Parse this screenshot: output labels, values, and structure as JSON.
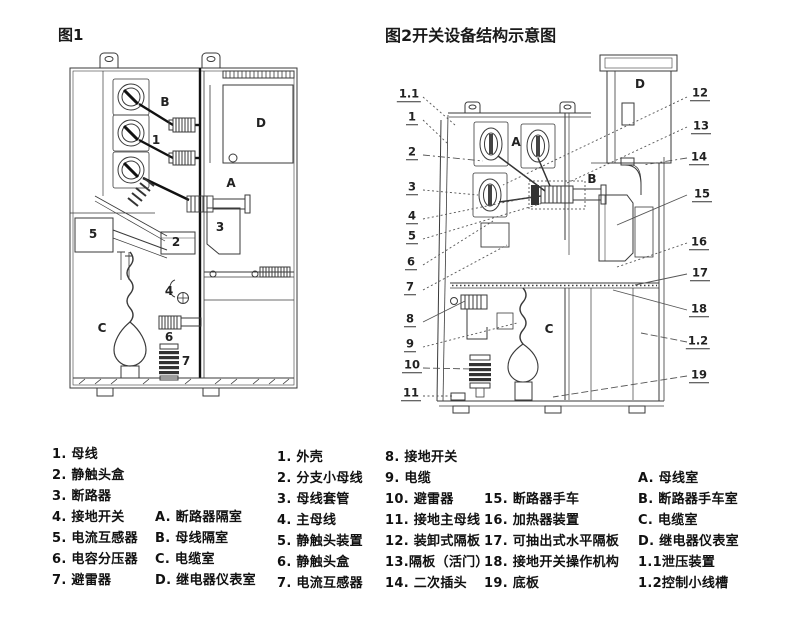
{
  "titles": {
    "fig1": "图1",
    "fig2": "图2开关设备结构示意图"
  },
  "colors": {
    "line": "#3a3a3a",
    "heavy_line": "#111111",
    "text": "#1a1a1a"
  },
  "fig1": {
    "labels": [
      "B",
      "1",
      "D",
      "A",
      "3",
      "2",
      "5",
      "4",
      "C",
      "6",
      "7"
    ]
  },
  "fig2": {
    "inner_labels": [
      "A",
      "B",
      "C",
      "D"
    ],
    "callouts_left": [
      "1.1",
      "1",
      "2",
      "3",
      "4",
      "5",
      "6",
      "7",
      "8",
      "9",
      "10",
      "11"
    ],
    "callouts_right": [
      "12",
      "13",
      "14",
      "15",
      "16",
      "17",
      "18",
      "1.2",
      "19"
    ]
  },
  "legend": {
    "col1": [
      "1. 母线",
      "2. 静触头盒",
      "3. 断路器",
      "4. 接地开关",
      "5. 电流互感器",
      "6. 电容分压器",
      "7. 避雷器"
    ],
    "col2": [
      "A. 断路器隔室",
      "B. 母线隔室",
      "C. 电缆室",
      "D. 继电器仪表室"
    ],
    "col3": [
      "1. 外壳",
      "2. 分支小母线",
      "3. 母线套管",
      "4. 主母线",
      "5. 静触头装置",
      "6. 静触头盒",
      "7. 电流互感器"
    ],
    "col4": [
      "8. 接地开关",
      "9. 电缆",
      "10. 避雷器",
      "11. 接地主母线",
      "12. 装卸式隔板",
      "13.隔板（活门）",
      "14. 二次插头"
    ],
    "col5": [
      "15. 断路器手车",
      "16. 加热器装置",
      "17. 可抽出式水平隔板",
      "18. 接地开关操作机构",
      "19. 底板"
    ],
    "col6": [
      "A. 母线室",
      "B. 断路器手车室",
      "C. 电缆室",
      "D. 继电器仪表室",
      "1.1泄压装置",
      "1.2控制小线槽"
    ]
  }
}
